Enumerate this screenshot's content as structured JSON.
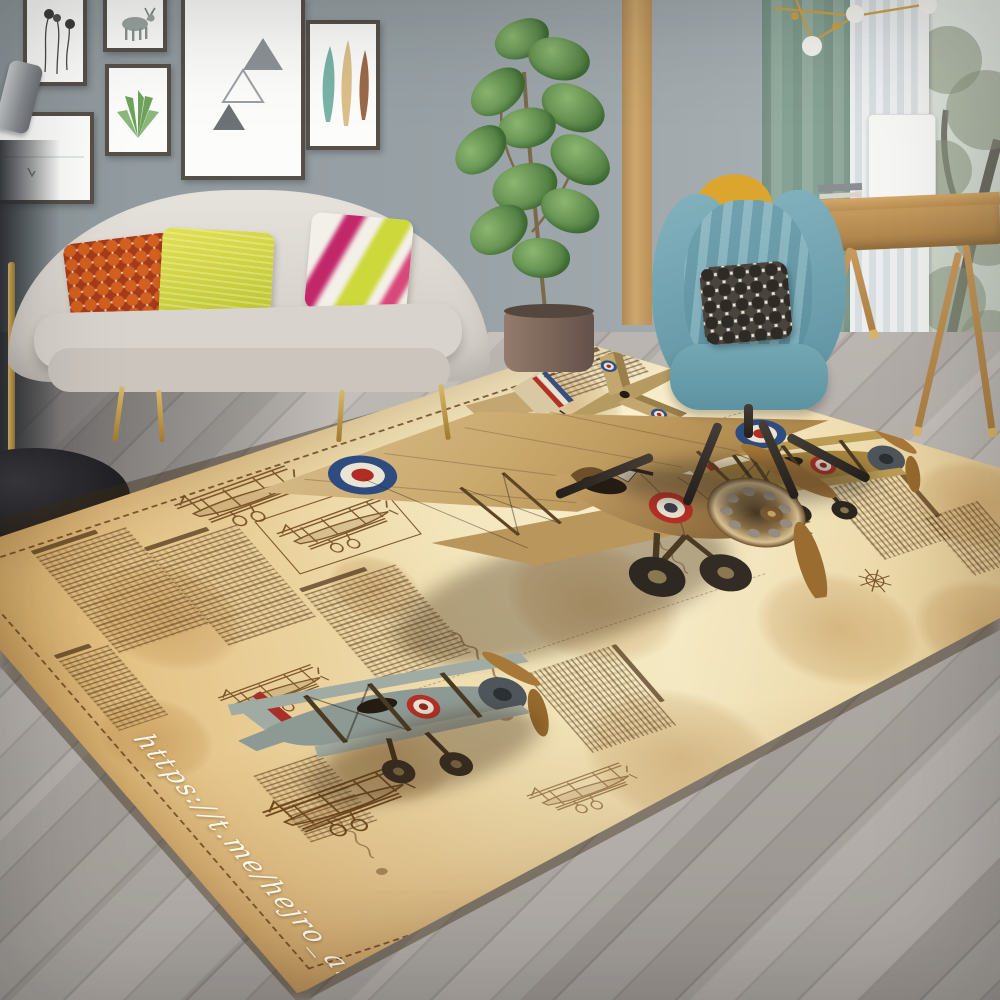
{
  "photo": {
    "subject": "vintage biplane aviation-blueprint area rug",
    "setting": "modern living room product scene",
    "rug": {
      "watermark": "https://t.me/hejro_art",
      "base_color": "#e7cc96",
      "parchment_light": "#f3e7c0",
      "parchment_deep": "#cfa262",
      "ink_color": "#5a3c1e",
      "border_style": "dashed-stitch",
      "motifs": [
        "large-biplane-photo",
        "gray-biplane-photo",
        "brown-biplane-photo",
        "top-view-biplane",
        "sketch-biplanes",
        "handwritten-columns",
        "ink-stains",
        "compass-stars"
      ]
    },
    "room": {
      "wall_color": "#98a1a5",
      "floor_color": "#b3ada7",
      "sofa_color": "#d8d3cc",
      "armchair_color": "#74a7b4",
      "curtain_color": "#8aa396",
      "accent_gold": "#c9a24a",
      "pillow_colors": [
        "#d2601e",
        "#c9d23a",
        "#c2276a"
      ]
    }
  }
}
